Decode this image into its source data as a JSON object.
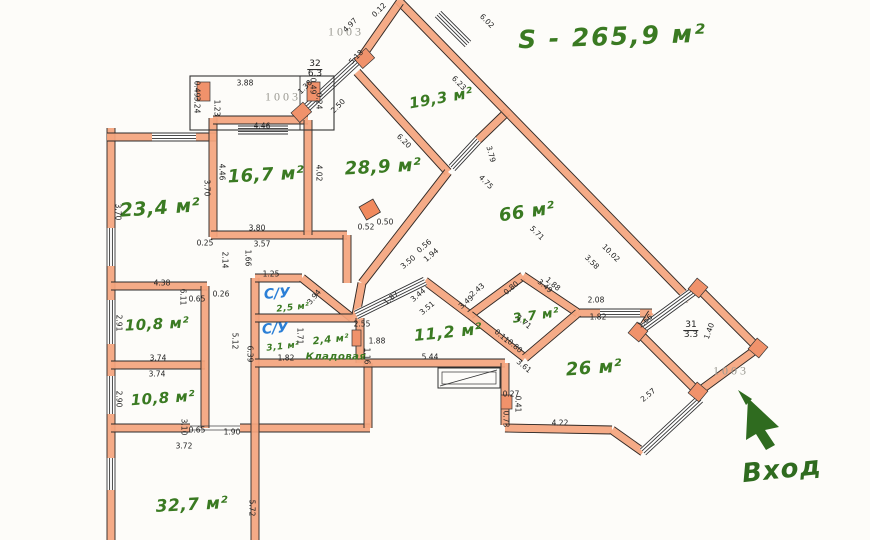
{
  "title": {
    "total_area": "S - 265,9 м²",
    "entrance": "Вход"
  },
  "rooms": [
    {
      "label": "23,4 м²",
      "x": 160,
      "y": 208,
      "fs": 19,
      "rot": -4
    },
    {
      "label": "16,7 м²",
      "x": 266,
      "y": 175,
      "fs": 18,
      "rot": -3
    },
    {
      "label": "28,9 м²",
      "x": 383,
      "y": 167,
      "fs": 18,
      "rot": -3
    },
    {
      "label": "19,3 м²",
      "x": 441,
      "y": 98,
      "fs": 15,
      "rot": -10
    },
    {
      "label": "66 м²",
      "x": 527,
      "y": 212,
      "fs": 18,
      "rot": -8
    },
    {
      "label": "10,8 м²",
      "x": 157,
      "y": 324,
      "fs": 15,
      "rot": -3
    },
    {
      "label": "10,8 м²",
      "x": 163,
      "y": 398,
      "fs": 15,
      "rot": -4
    },
    {
      "label": "32,7 м²",
      "x": 192,
      "y": 505,
      "fs": 17,
      "rot": -3
    },
    {
      "label": "11,2 м²",
      "x": 448,
      "y": 332,
      "fs": 16,
      "rot": -6
    },
    {
      "label": "3,7 м²",
      "x": 536,
      "y": 316,
      "fs": 13,
      "rot": -8
    },
    {
      "label": "26 м²",
      "x": 594,
      "y": 368,
      "fs": 18,
      "rot": -4
    },
    {
      "label": "2,5 м²",
      "x": 293,
      "y": 308,
      "fs": 9,
      "rot": -6
    },
    {
      "label": "3,1 м²",
      "x": 283,
      "y": 347,
      "fs": 9,
      "rot": -6
    },
    {
      "label": "2,4 м²",
      "x": 331,
      "y": 340,
      "fs": 10,
      "rot": -6
    },
    {
      "label": "Кладовая",
      "x": 336,
      "y": 357,
      "fs": 10,
      "rot": 0
    }
  ],
  "wc_labels": [
    {
      "label": "С/У",
      "x": 277,
      "y": 294
    },
    {
      "label": "С/У",
      "x": 275,
      "y": 329
    }
  ],
  "stamps": [
    {
      "text": "1003",
      "x": 283,
      "y": 97
    },
    {
      "text": "1003",
      "x": 346,
      "y": 32
    },
    {
      "text": "1003",
      "x": 731,
      "y": 371
    }
  ],
  "fractions": [
    {
      "num": "32",
      "den": "6.3",
      "x": 315,
      "y": 70
    },
    {
      "num": "31",
      "den": "3.3",
      "x": 691,
      "y": 331
    }
  ],
  "dimensions": [
    {
      "t": "3.88",
      "x": 245,
      "y": 83,
      "r": 0
    },
    {
      "t": "0.49",
      "x": 197,
      "y": 89,
      "r": 90
    },
    {
      "t": "3.24",
      "x": 197,
      "y": 105,
      "r": 90
    },
    {
      "t": "1.23",
      "x": 217,
      "y": 108,
      "r": 90
    },
    {
      "t": "0.49",
      "x": 313,
      "y": 86,
      "r": 90
    },
    {
      "t": "0.24",
      "x": 319,
      "y": 101,
      "r": 90
    },
    {
      "t": "4.46",
      "x": 262,
      "y": 126,
      "r": 0
    },
    {
      "t": "4.97",
      "x": 350,
      "y": 25,
      "r": -45
    },
    {
      "t": "5.18",
      "x": 356,
      "y": 57,
      "r": -45
    },
    {
      "t": "0.12",
      "x": 379,
      "y": 10,
      "r": -45
    },
    {
      "t": "1.38",
      "x": 305,
      "y": 87,
      "r": -45
    },
    {
      "t": "2.50",
      "x": 338,
      "y": 106,
      "r": -45
    },
    {
      "t": "6.02",
      "x": 487,
      "y": 21,
      "r": 45
    },
    {
      "t": "6.23",
      "x": 459,
      "y": 83,
      "r": 45
    },
    {
      "t": "6.20",
      "x": 404,
      "y": 141,
      "r": 45
    },
    {
      "t": "3.79",
      "x": 491,
      "y": 154,
      "r": 75
    },
    {
      "t": "4.75",
      "x": 486,
      "y": 182,
      "r": 45
    },
    {
      "t": "5.71",
      "x": 537,
      "y": 233,
      "r": 45
    },
    {
      "t": "10.02",
      "x": 611,
      "y": 253,
      "r": 45
    },
    {
      "t": "3.58",
      "x": 592,
      "y": 262,
      "r": 45
    },
    {
      "t": "3.70",
      "x": 118,
      "y": 212,
      "r": 90
    },
    {
      "t": "3.70",
      "x": 207,
      "y": 188,
      "r": 90
    },
    {
      "t": "4.46",
      "x": 222,
      "y": 172,
      "r": 90
    },
    {
      "t": "3.80",
      "x": 257,
      "y": 228,
      "r": 0
    },
    {
      "t": "3.57",
      "x": 262,
      "y": 244,
      "r": 0
    },
    {
      "t": "0.25",
      "x": 205,
      "y": 243,
      "r": 0
    },
    {
      "t": "1.66",
      "x": 248,
      "y": 258,
      "r": 90
    },
    {
      "t": "2.14",
      "x": 225,
      "y": 260,
      "r": 90
    },
    {
      "t": "4.02",
      "x": 319,
      "y": 173,
      "r": 90
    },
    {
      "t": "0.52",
      "x": 366,
      "y": 227,
      "r": 0
    },
    {
      "t": "0.50",
      "x": 385,
      "y": 222,
      "r": 0
    },
    {
      "t": "3.50",
      "x": 408,
      "y": 262,
      "r": -40
    },
    {
      "t": "1.94",
      "x": 431,
      "y": 255,
      "r": -40
    },
    {
      "t": "0.56",
      "x": 424,
      "y": 246,
      "r": -40
    },
    {
      "t": "4.38",
      "x": 162,
      "y": 283,
      "r": 0
    },
    {
      "t": "6.11",
      "x": 183,
      "y": 297,
      "r": 90
    },
    {
      "t": "0.65",
      "x": 197,
      "y": 299,
      "r": 0
    },
    {
      "t": "0.26",
      "x": 221,
      "y": 294,
      "r": 0
    },
    {
      "t": "2.91",
      "x": 119,
      "y": 323,
      "r": 90
    },
    {
      "t": "3.74",
      "x": 158,
      "y": 358,
      "r": 0
    },
    {
      "t": "3.74",
      "x": 157,
      "y": 374,
      "r": 0
    },
    {
      "t": "2.90",
      "x": 119,
      "y": 399,
      "r": 90
    },
    {
      "t": "3.10",
      "x": 184,
      "y": 427,
      "r": 90
    },
    {
      "t": "0.65",
      "x": 197,
      "y": 430,
      "r": 0
    },
    {
      "t": "1.90",
      "x": 232,
      "y": 432,
      "r": 0
    },
    {
      "t": "3.72",
      "x": 184,
      "y": 446,
      "r": 0
    },
    {
      "t": "5.12",
      "x": 235,
      "y": 341,
      "r": 90
    },
    {
      "t": "6.39",
      "x": 250,
      "y": 354,
      "r": 90
    },
    {
      "t": "5.72",
      "x": 252,
      "y": 508,
      "r": 90
    },
    {
      "t": "1.25",
      "x": 271,
      "y": 274,
      "r": 0
    },
    {
      "t": "3.94",
      "x": 314,
      "y": 297,
      "r": -50
    },
    {
      "t": "1.71",
      "x": 300,
      "y": 336,
      "r": 90
    },
    {
      "t": "1.82",
      "x": 286,
      "y": 358,
      "r": 0
    },
    {
      "t": "2.55",
      "x": 362,
      "y": 324,
      "r": 0
    },
    {
      "t": "1.88",
      "x": 377,
      "y": 341,
      "r": 0
    },
    {
      "t": "1.16",
      "x": 367,
      "y": 356,
      "r": 90
    },
    {
      "t": "1.87",
      "x": 391,
      "y": 298,
      "r": -40
    },
    {
      "t": "3.44",
      "x": 418,
      "y": 295,
      "r": -40
    },
    {
      "t": "3.51",
      "x": 427,
      "y": 308,
      "r": -40
    },
    {
      "t": "2.43",
      "x": 477,
      "y": 290,
      "r": -40
    },
    {
      "t": "3.49",
      "x": 466,
      "y": 302,
      "r": -40
    },
    {
      "t": "0.80",
      "x": 511,
      "y": 288,
      "r": -40
    },
    {
      "t": "3.49",
      "x": 545,
      "y": 286,
      "r": 40
    },
    {
      "t": "1.88",
      "x": 553,
      "y": 284,
      "r": 40
    },
    {
      "t": "1.71",
      "x": 524,
      "y": 322,
      "r": 40
    },
    {
      "t": "0.11",
      "x": 502,
      "y": 336,
      "r": 40
    },
    {
      "t": "0.80",
      "x": 515,
      "y": 346,
      "r": 40
    },
    {
      "t": "3.61",
      "x": 524,
      "y": 366,
      "r": 40
    },
    {
      "t": "5.44",
      "x": 430,
      "y": 357,
      "r": 0
    },
    {
      "t": "0.27",
      "x": 511,
      "y": 394,
      "r": 0
    },
    {
      "t": "0.41",
      "x": 518,
      "y": 404,
      "r": 90
    },
    {
      "t": "0.73",
      "x": 506,
      "y": 419,
      "r": 90
    },
    {
      "t": "4.22",
      "x": 560,
      "y": 423,
      "r": 0
    },
    {
      "t": "2.08",
      "x": 596,
      "y": 300,
      "r": 0
    },
    {
      "t": "1.82",
      "x": 598,
      "y": 317,
      "r": 0
    },
    {
      "t": "1.66",
      "x": 645,
      "y": 321,
      "r": -40
    },
    {
      "t": "1.40",
      "x": 709,
      "y": 331,
      "r": -70
    },
    {
      "t": "2.57",
      "x": 648,
      "y": 395,
      "r": -40
    }
  ]
}
